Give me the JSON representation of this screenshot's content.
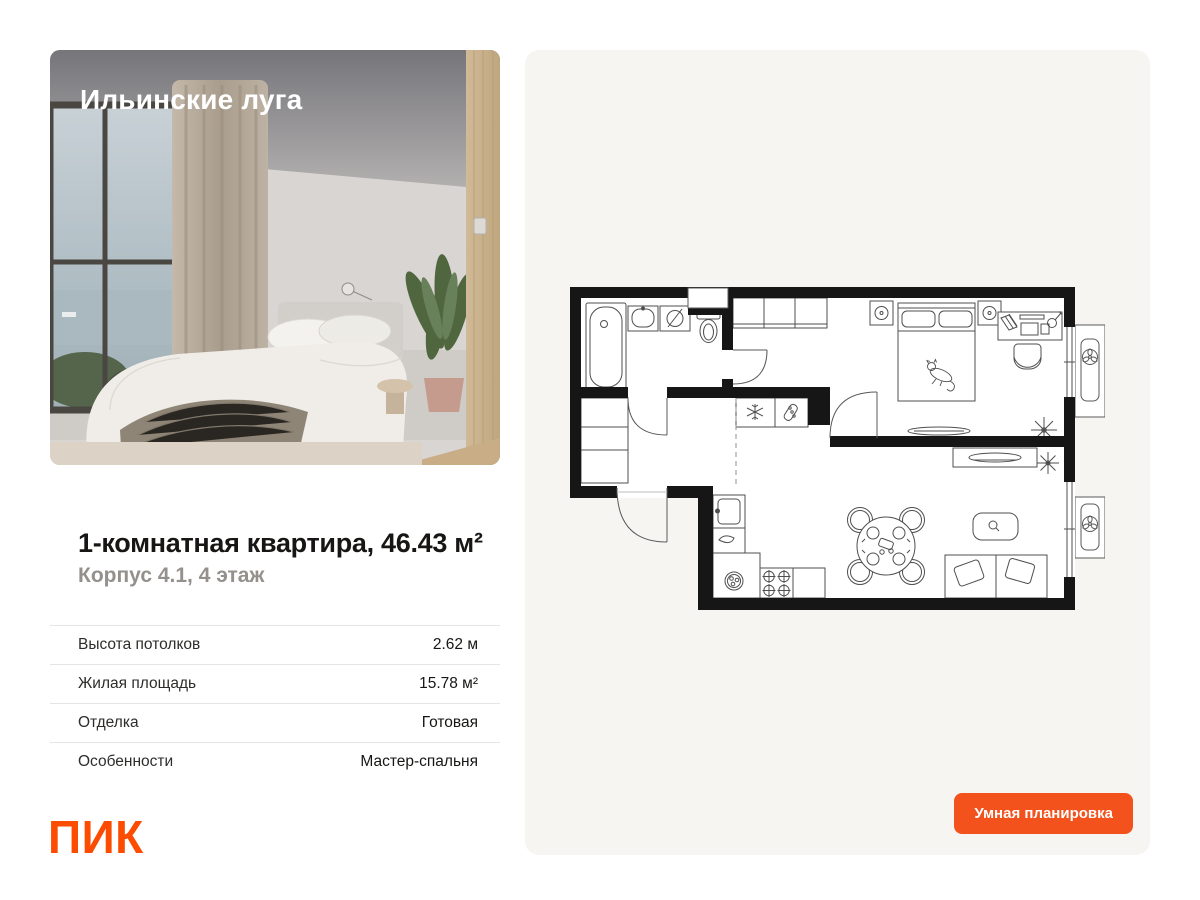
{
  "photo": {
    "project_name": "Ильинские луга"
  },
  "listing": {
    "title": "1-комнатная квартира, 46.43 м²",
    "subtitle": "Корпус 4.1, 4 этаж"
  },
  "details": {
    "rows": [
      {
        "label": "Высота потолков",
        "value": "2.62 м"
      },
      {
        "label": "Жилая площадь",
        "value": "15.78 м²"
      },
      {
        "label": "Отделка",
        "value": "Готовая"
      },
      {
        "label": "Особенности",
        "value": "Мастер-спальня"
      }
    ]
  },
  "brand": {
    "logo_text": "ПИК",
    "brand_color": "#fb4c02"
  },
  "floorplan": {
    "button_label": "Умная планировка",
    "accent_color": "#f4521c",
    "panel_background": "#f6f5f2"
  }
}
